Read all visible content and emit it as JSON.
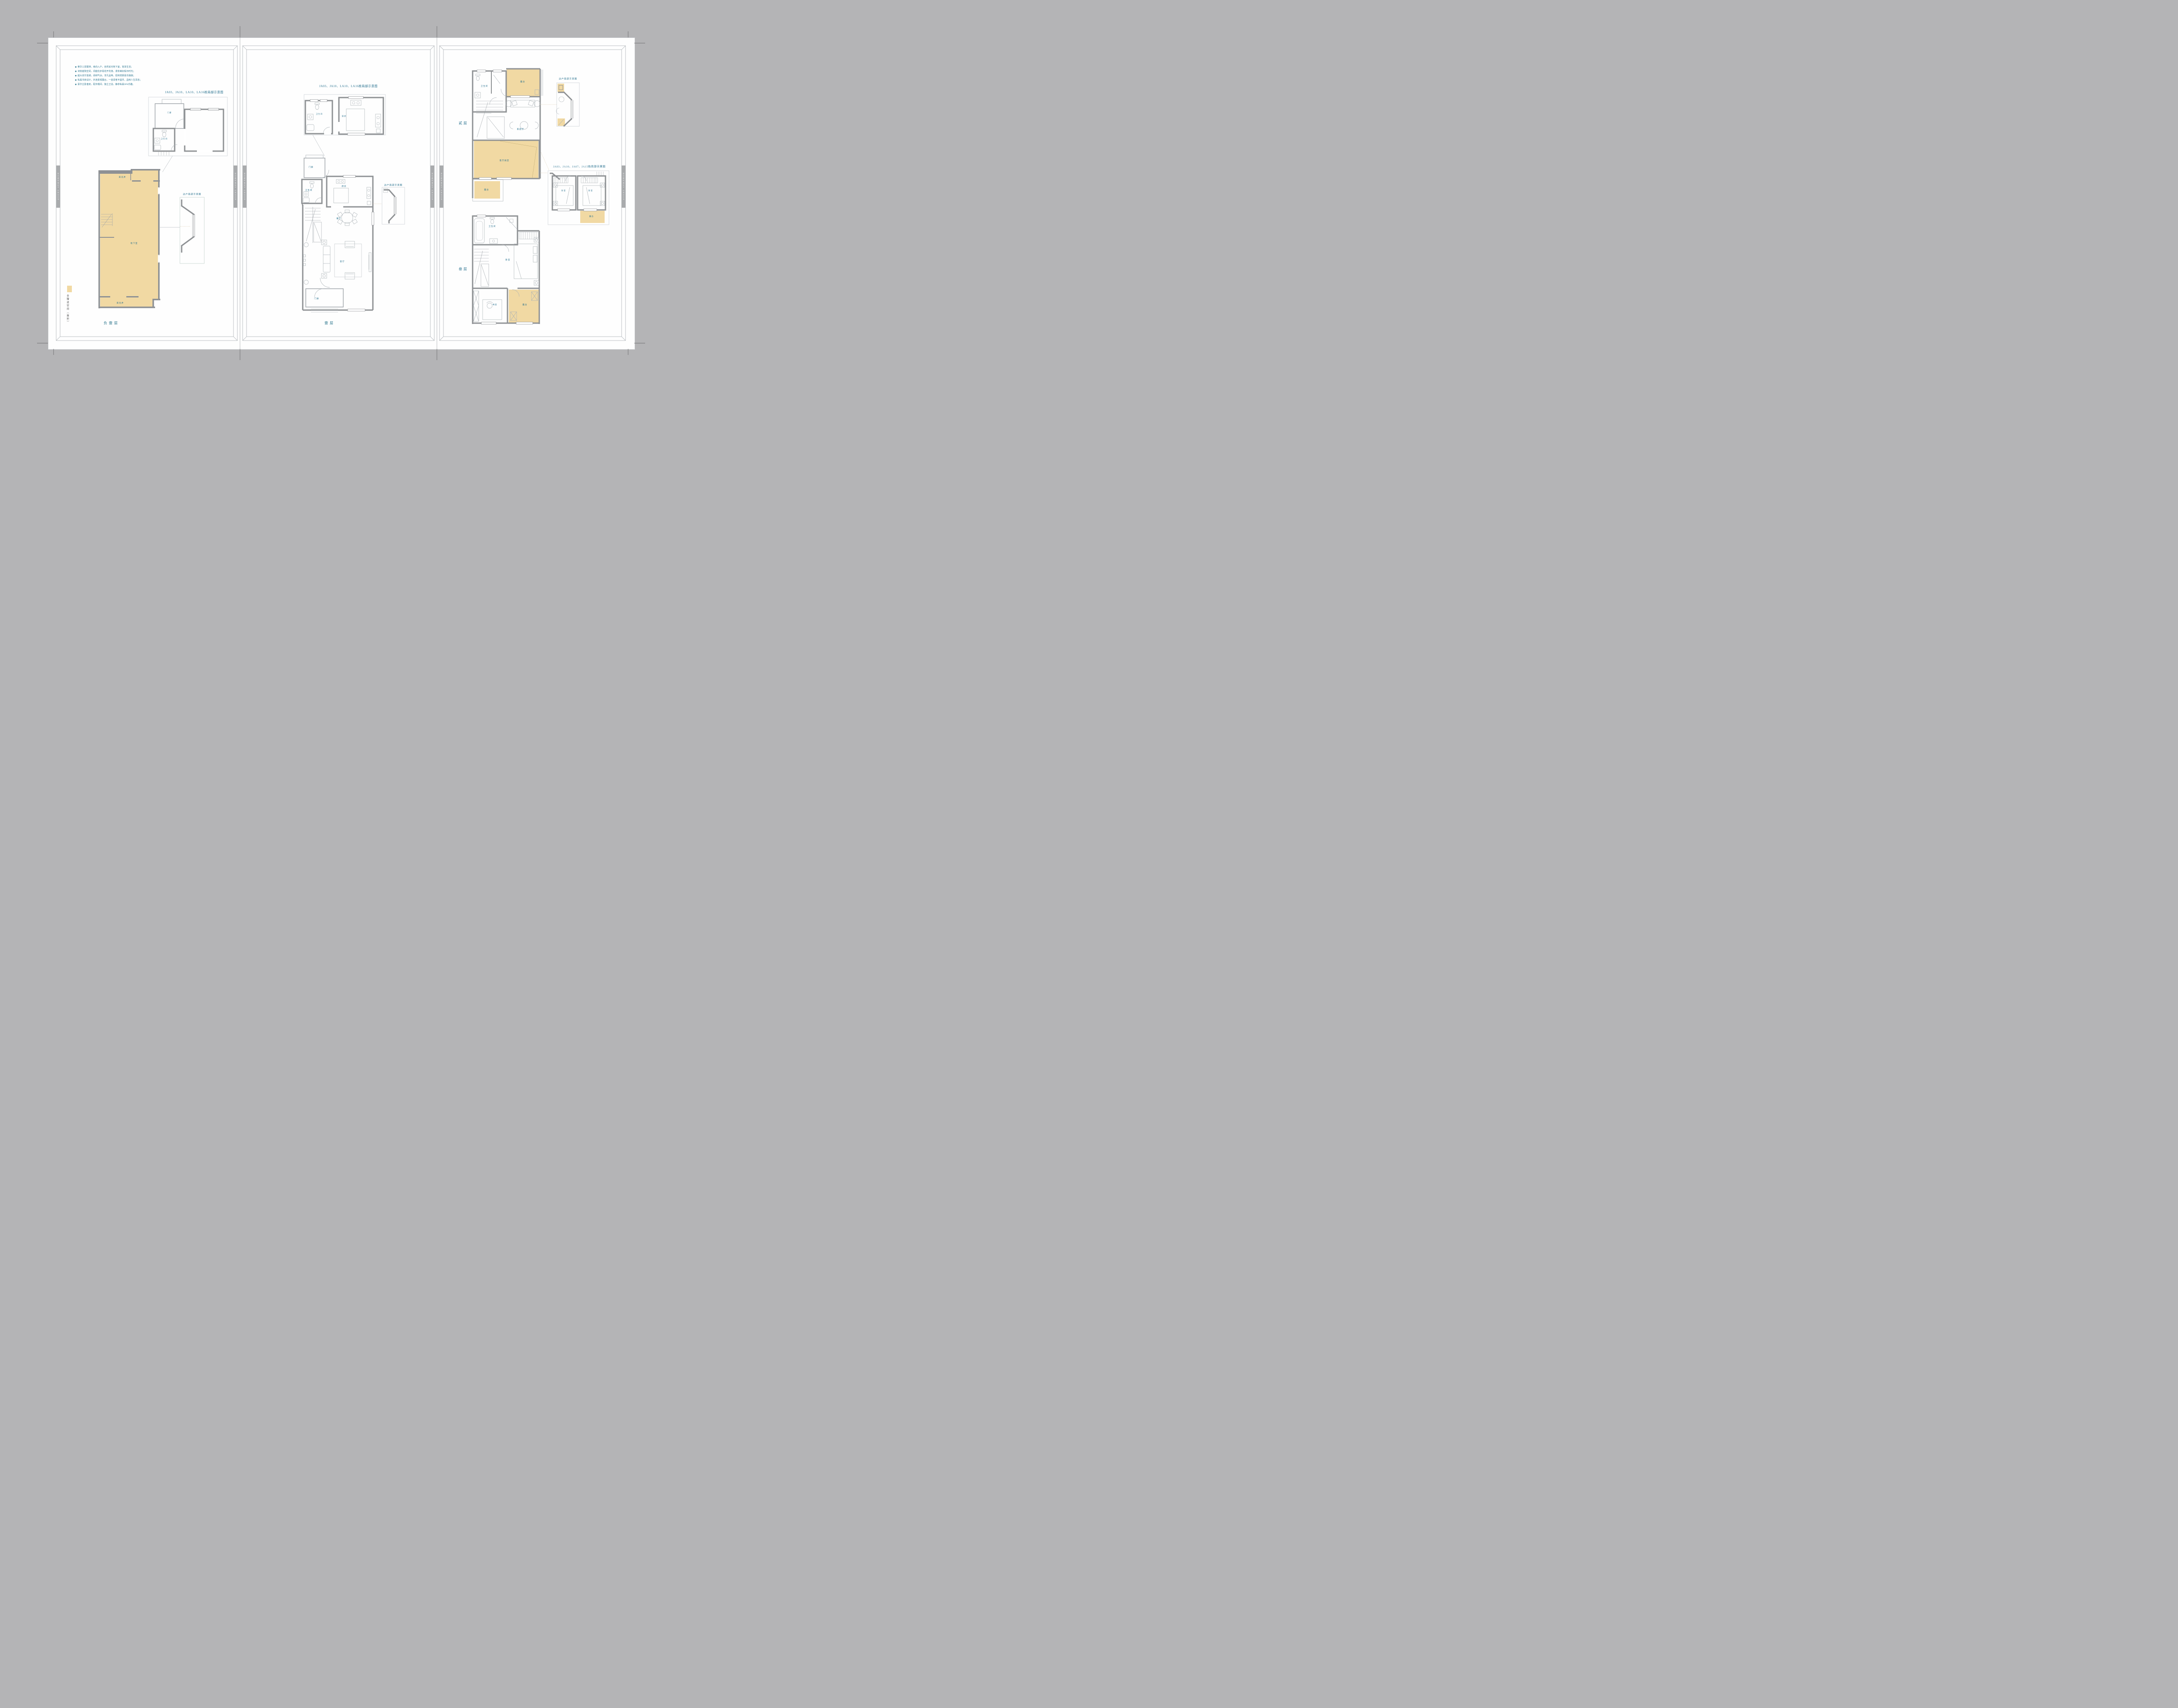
{
  "colors": {
    "background": "#b4b4b6",
    "sheet": "#fefefe",
    "accent_teal": "#26708e",
    "highlight_yellow": "#f1d9a3",
    "wall_gray": "#8e9194",
    "spine_bar_gray": "#a9abad",
    "legend_text_gray": "#4a4a4a"
  },
  "spine": {
    "text": "HOMEWAY GROUP"
  },
  "page1": {
    "bullet": "◉",
    "features": [
      "奢华三层联排，南向入户，自然采光地下室，宽享生活；",
      "诗意庭院空间，闲庭信步看花开花落，漫享美好假日时光；",
      "超大双厅连通，阔绰气派，非凡品味，招待宾朋喜乐融融；",
      "私属书房设计，外连景观露台，一壶清茗半盏月，品味人生百态；",
      "豪华主卧套房，配衣帽间、独立卫浴，静享私属SPA乐趣。"
    ],
    "title": "JA03、JA10、LA10、LA16栋局部示意图",
    "small_plan": {
      "porch": "门廊",
      "bath": "卫生间"
    },
    "side_unit_label": "边户局部示意图",
    "basement": {
      "light_well": "采光井",
      "room": "地下室"
    },
    "legend": "全赠送空间（面积）",
    "caption": "负壹层"
  },
  "page2": {
    "title": "JA03、JA10、LA10、LA16栋局部示意图",
    "small_plan": {
      "bath": "卫生间",
      "kitchen": "厨房"
    },
    "rooms": {
      "porch": "门廊",
      "bath": "卫生间",
      "kitchen": "厨房",
      "dining": "餐厅",
      "living": "客厅",
      "porch2": "门廊"
    },
    "side_unit_label": "边户局部示意图",
    "caption": "壹层"
  },
  "page3": {
    "floor2": "贰层",
    "floor3": "叁层",
    "f2": {
      "bath": "卫生间",
      "terrace": "露台",
      "family": "家庭厅",
      "void": "客厅挑空",
      "terrace2": "露台"
    },
    "f3": {
      "bath": "卫生间",
      "bedroom": "卧室",
      "study": "书房",
      "terrace": "露台"
    },
    "side_unit_label": "边户局部示意图",
    "title": "JA03、JA10、JA07、JA15栋局部示意图",
    "small_plan": {
      "bedroom": "卧室",
      "terrace": "露台"
    }
  }
}
